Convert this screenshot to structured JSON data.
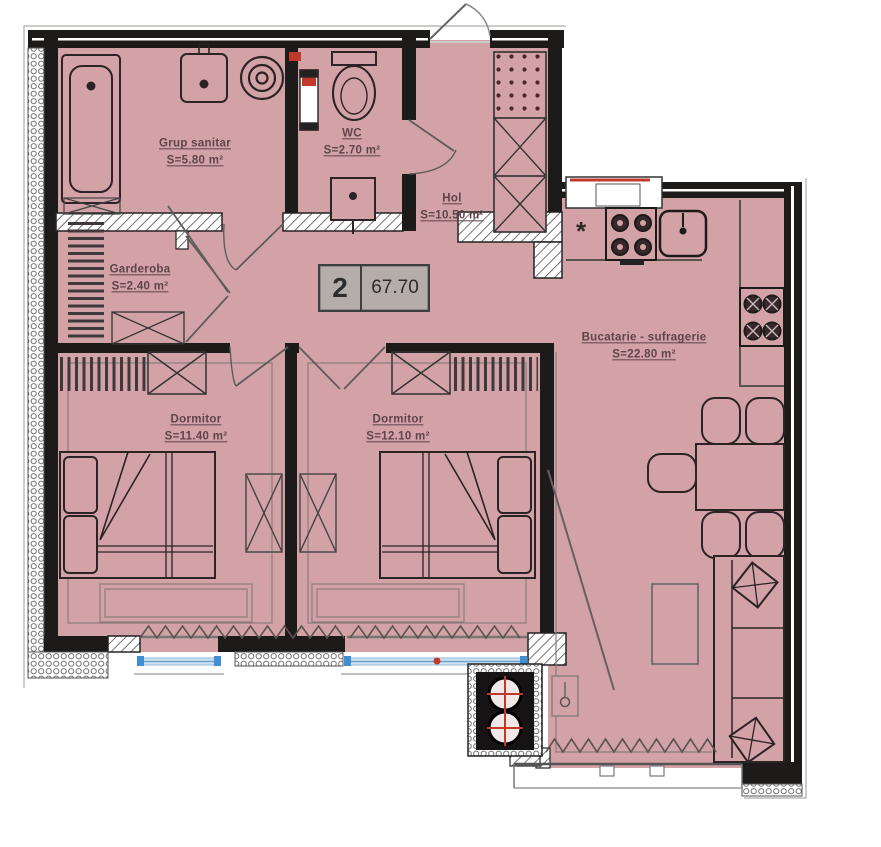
{
  "unit": {
    "rooms_count": "2",
    "total_area": "67.70"
  },
  "rooms": {
    "grup_sanitar": {
      "name": "Grup sanitar",
      "area": "S=5.80 m²"
    },
    "wc": {
      "name": "WC",
      "area": "S=2.70 m²"
    },
    "hol": {
      "name": "Hol",
      "area": "S=10.50 m²"
    },
    "garderoba": {
      "name": "Garderoba",
      "area": "S=2.40 m²"
    },
    "dormitor_1": {
      "name": "Dormitor",
      "area": "S=11.40 m²"
    },
    "dormitor_2": {
      "name": "Dormitor",
      "area": "S=12.10 m²"
    },
    "bucatarie": {
      "name": "Bucatarie - sufragerie",
      "area": "S=22.80 m²"
    }
  },
  "annotations": {
    "kitchen_note": "*"
  },
  "colors": {
    "floor": "#d3a2a7",
    "wall": "#1d1a1a",
    "accent_red": "#c0392b",
    "window_blue": "#a9cce3",
    "label_text": "#5f4448",
    "unit_box_bg": "#b5adaa"
  }
}
